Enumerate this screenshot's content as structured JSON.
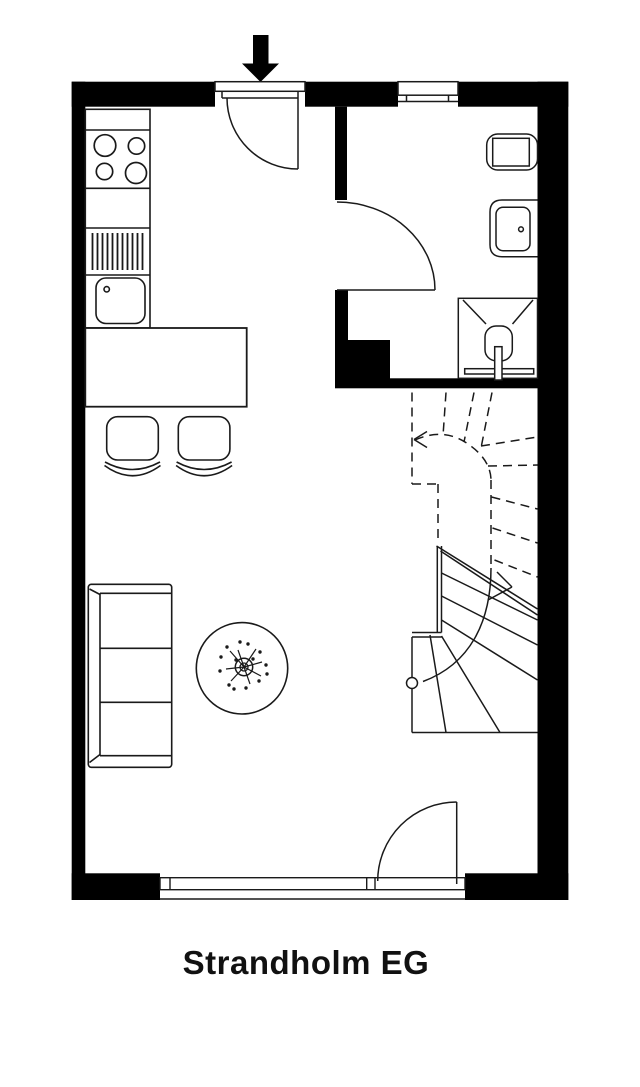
{
  "title": "Strandholm EG",
  "colors": {
    "wall": "#000000",
    "line": "#1a1a1a",
    "background": "#ffffff"
  },
  "elements": [
    "entrance-arrow",
    "entrance-door",
    "bathroom-window",
    "bathroom-door",
    "toilet",
    "washbasin",
    "shower",
    "staircase",
    "kitchen-counter",
    "stove",
    "kitchen-sink",
    "dining-table",
    "dining-chairs",
    "sofa",
    "plant-table",
    "terrace-window",
    "terrace-door"
  ]
}
